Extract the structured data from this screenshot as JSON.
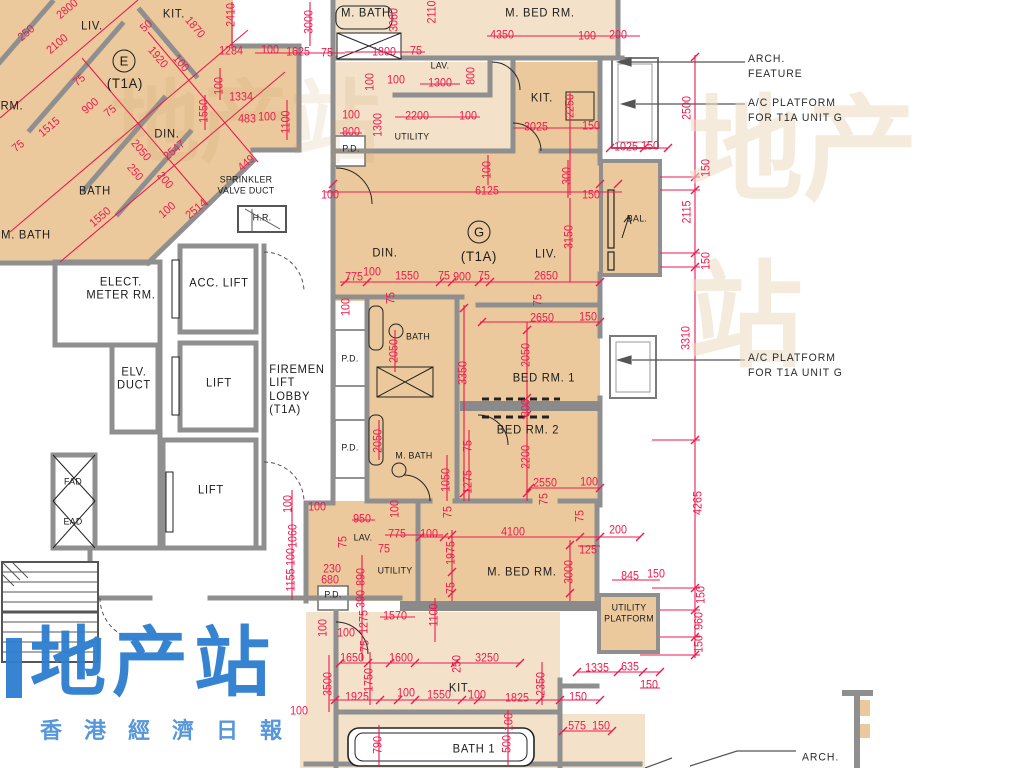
{
  "document": {
    "kind": "architectural floor plan",
    "tower_type": "T1A"
  },
  "palette": {
    "unit_fill": "#ebc99c",
    "unit_fill_light": "#f3e2c9",
    "wall_gray": "#8f8f8f",
    "dim_red": "#ed1a4e",
    "text_black": "#1b1b1b",
    "watermark_blue": "#2e7fd0"
  },
  "watermark": {
    "title": "地产站",
    "subtitle": "香港經濟日報"
  },
  "units": [
    {
      "id": "E",
      "badge": "E",
      "type": "(T1A)"
    },
    {
      "id": "G",
      "badge": "G",
      "type": "(T1A)"
    }
  ],
  "annotations": [
    {
      "t": "ARCH.\nFEATURE",
      "x": 748,
      "y": 67
    },
    {
      "t": "A/C PLATFORM\nFOR T1A UNIT G",
      "x": 748,
      "y": 111
    },
    {
      "t": "A/C PLATFORM\nFOR T1A UNIT G",
      "x": 748,
      "y": 366
    },
    {
      "t": "ARCH.",
      "x": 802,
      "y": 758
    }
  ],
  "rooms": [
    {
      "t": "LIV.",
      "x": 92,
      "y": 26
    },
    {
      "t": "KIT.",
      "x": 174,
      "y": 14
    },
    {
      "t": "E",
      "x": 124,
      "y": 61,
      "k": "badge"
    },
    {
      "t": "(T1A)",
      "x": 125,
      "y": 84,
      "k": "big"
    },
    {
      "t": "DIN.",
      "x": 167,
      "y": 134
    },
    {
      "t": "RM.",
      "x": 12,
      "y": 106
    },
    {
      "t": "BATH",
      "x": 95,
      "y": 191
    },
    {
      "t": "M. BATH",
      "x": 26,
      "y": 235
    },
    {
      "t": "SPRINKLER\nVALVE DUCT",
      "x": 246,
      "y": 186,
      "k": "small"
    },
    {
      "t": "H.R.",
      "x": 262,
      "y": 219,
      "k": "small"
    },
    {
      "t": "M. BATH",
      "x": 366,
      "y": 13
    },
    {
      "t": "M. BED RM.",
      "x": 540,
      "y": 13
    },
    {
      "t": "LAV.",
      "x": 440,
      "y": 67,
      "k": "small"
    },
    {
      "t": "UTILITY",
      "x": 412,
      "y": 138,
      "k": "small"
    },
    {
      "t": "P.D.",
      "x": 351,
      "y": 150,
      "k": "small"
    },
    {
      "t": "KIT.",
      "x": 542,
      "y": 98
    },
    {
      "t": "G",
      "x": 479,
      "y": 232,
      "k": "badge"
    },
    {
      "t": "(T1A)",
      "x": 479,
      "y": 257,
      "k": "big"
    },
    {
      "t": "DIN.",
      "x": 385,
      "y": 253
    },
    {
      "t": "LIV.",
      "x": 546,
      "y": 254
    },
    {
      "t": "BAL.",
      "x": 637,
      "y": 220,
      "k": "small"
    },
    {
      "t": "ELECT.\nMETER RM.",
      "x": 121,
      "y": 289
    },
    {
      "t": "ACC. LIFT",
      "x": 219,
      "y": 283
    },
    {
      "t": "ELV.\nDUCT",
      "x": 134,
      "y": 379
    },
    {
      "t": "LIFT",
      "x": 219,
      "y": 383
    },
    {
      "t": "FIREMEN\nLIFT\nLOBBY\n(T1A)",
      "x": 297,
      "y": 390,
      "k": "left"
    },
    {
      "t": "LIFT",
      "x": 211,
      "y": 490
    },
    {
      "t": "FAD",
      "x": 73,
      "y": 483,
      "k": "small"
    },
    {
      "t": "EAD",
      "x": 73,
      "y": 523,
      "k": "small"
    },
    {
      "t": "P.D.",
      "x": 350,
      "y": 360,
      "k": "small"
    },
    {
      "t": "BATH",
      "x": 418,
      "y": 338,
      "k": "small"
    },
    {
      "t": "BED RM. 1",
      "x": 544,
      "y": 378
    },
    {
      "t": "P.D.",
      "x": 350,
      "y": 449,
      "k": "small"
    },
    {
      "t": "BED RM. 2",
      "x": 528,
      "y": 430
    },
    {
      "t": "M. BATH",
      "x": 414,
      "y": 457,
      "k": "small"
    },
    {
      "t": "LAV.",
      "x": 363,
      "y": 539,
      "k": "small"
    },
    {
      "t": "UTILITY",
      "x": 395,
      "y": 572,
      "k": "small"
    },
    {
      "t": "P.D.",
      "x": 333,
      "y": 596,
      "k": "small"
    },
    {
      "t": "M. BED RM.",
      "x": 522,
      "y": 572
    },
    {
      "t": "UTILITY\nPLATFORM",
      "x": 629,
      "y": 614,
      "k": "small"
    },
    {
      "t": "KIT.",
      "x": 460,
      "y": 688
    },
    {
      "t": "BATH 1",
      "x": 474,
      "y": 749
    }
  ],
  "dims": [
    {
      "t": "2800",
      "x": 68,
      "y": 10,
      "r": -40
    },
    {
      "t": "50",
      "x": 147,
      "y": 27,
      "r": -40
    },
    {
      "t": "250",
      "x": 27,
      "y": 34,
      "r": -40
    },
    {
      "t": "2100",
      "x": 58,
      "y": 45,
      "r": -40
    },
    {
      "t": "1870",
      "x": 194,
      "y": 28,
      "r": 50
    },
    {
      "t": "1920",
      "x": 157,
      "y": 58,
      "r": 50
    },
    {
      "t": "100",
      "x": 180,
      "y": 64,
      "r": 50
    },
    {
      "t": "2410",
      "x": 232,
      "y": 15,
      "r": -90
    },
    {
      "t": "1284",
      "x": 231,
      "y": 52,
      "r": 0
    },
    {
      "t": "100",
      "x": 270,
      "y": 51,
      "r": 0
    },
    {
      "t": "1625",
      "x": 298,
      "y": 53,
      "r": 0
    },
    {
      "t": "75",
      "x": 327,
      "y": 54,
      "r": 0
    },
    {
      "t": "3000",
      "x": 310,
      "y": 22,
      "r": -90
    },
    {
      "t": "100",
      "x": 220,
      "y": 86,
      "r": -90
    },
    {
      "t": "1334",
      "x": 241,
      "y": 98,
      "r": 0
    },
    {
      "t": "1550",
      "x": 205,
      "y": 111,
      "r": -90
    },
    {
      "t": "483",
      "x": 247,
      "y": 120,
      "r": 0
    },
    {
      "t": "100",
      "x": 267,
      "y": 118,
      "r": 0
    },
    {
      "t": "1100",
      "x": 287,
      "y": 122,
      "r": -90
    },
    {
      "t": "75",
      "x": 80,
      "y": 81,
      "r": -40
    },
    {
      "t": "900",
      "x": 91,
      "y": 107,
      "r": -40
    },
    {
      "t": "75",
      "x": 111,
      "y": 112,
      "r": -40
    },
    {
      "t": "1515",
      "x": 50,
      "y": 128,
      "r": -40
    },
    {
      "t": "75",
      "x": 19,
      "y": 147,
      "r": -40
    },
    {
      "t": "2050",
      "x": 140,
      "y": 151,
      "r": 50
    },
    {
      "t": "2547",
      "x": 175,
      "y": 151,
      "r": -40
    },
    {
      "t": "250",
      "x": 134,
      "y": 173,
      "r": 50
    },
    {
      "t": "200",
      "x": 164,
      "y": 181,
      "r": 50
    },
    {
      "t": "449",
      "x": 247,
      "y": 164,
      "r": -40
    },
    {
      "t": "1550",
      "x": 101,
      "y": 218,
      "r": -40
    },
    {
      "t": "2514",
      "x": 197,
      "y": 210,
      "r": -40
    },
    {
      "t": "100",
      "x": 168,
      "y": 211,
      "r": -40
    },
    {
      "t": "3060",
      "x": 395,
      "y": 20,
      "r": -90
    },
    {
      "t": "2110",
      "x": 433,
      "y": 12,
      "r": -90
    },
    {
      "t": "4350",
      "x": 502,
      "y": 36,
      "r": 0
    },
    {
      "t": "100",
      "x": 587,
      "y": 37,
      "r": 0
    },
    {
      "t": "200",
      "x": 618,
      "y": 36,
      "r": 0
    },
    {
      "t": "1800",
      "x": 384,
      "y": 53,
      "r": 0
    },
    {
      "t": "75",
      "x": 416,
      "y": 52,
      "r": 0
    },
    {
      "t": "100",
      "x": 371,
      "y": 82,
      "r": -90
    },
    {
      "t": "100",
      "x": 396,
      "y": 81,
      "r": 0
    },
    {
      "t": "1300",
      "x": 440,
      "y": 84,
      "r": 0
    },
    {
      "t": "800",
      "x": 472,
      "y": 76,
      "r": -90
    },
    {
      "t": "2200",
      "x": 417,
      "y": 117,
      "r": 0
    },
    {
      "t": "100",
      "x": 468,
      "y": 117,
      "r": 0
    },
    {
      "t": "1300",
      "x": 379,
      "y": 125,
      "r": -90
    },
    {
      "t": "100",
      "x": 351,
      "y": 116,
      "r": 0
    },
    {
      "t": "800",
      "x": 351,
      "y": 133,
      "r": 0
    },
    {
      "t": "2250",
      "x": 571,
      "y": 106,
      "r": -90
    },
    {
      "t": "3025",
      "x": 536,
      "y": 128,
      "r": 0
    },
    {
      "t": "150",
      "x": 591,
      "y": 127,
      "r": 0
    },
    {
      "t": "1025",
      "x": 626,
      "y": 148,
      "r": 0
    },
    {
      "t": "150",
      "x": 650,
      "y": 147,
      "r": 0
    },
    {
      "t": "2500",
      "x": 688,
      "y": 108,
      "r": -90
    },
    {
      "t": "100",
      "x": 330,
      "y": 196,
      "r": 0
    },
    {
      "t": "6125",
      "x": 487,
      "y": 192,
      "r": 0
    },
    {
      "t": "150",
      "x": 591,
      "y": 196,
      "r": 0
    },
    {
      "t": "300",
      "x": 568,
      "y": 176,
      "r": -90
    },
    {
      "t": "100",
      "x": 488,
      "y": 170,
      "r": -90
    },
    {
      "t": "3150",
      "x": 570,
      "y": 237,
      "r": -90
    },
    {
      "t": "775",
      "x": 354,
      "y": 278,
      "r": 0
    },
    {
      "t": "100",
      "x": 372,
      "y": 273,
      "r": 0
    },
    {
      "t": "1550",
      "x": 407,
      "y": 277,
      "r": 0
    },
    {
      "t": "75",
      "x": 444,
      "y": 277,
      "r": 0
    },
    {
      "t": "900",
      "x": 462,
      "y": 278,
      "r": 0
    },
    {
      "t": "75",
      "x": 484,
      "y": 277,
      "r": 0
    },
    {
      "t": "2650",
      "x": 546,
      "y": 277,
      "r": 0
    },
    {
      "t": "75",
      "x": 392,
      "y": 298,
      "r": -90
    },
    {
      "t": "75",
      "x": 539,
      "y": 300,
      "r": -90
    },
    {
      "t": "100",
      "x": 347,
      "y": 307,
      "r": -90
    },
    {
      "t": "150",
      "x": 707,
      "y": 168,
      "r": -90
    },
    {
      "t": "2115",
      "x": 688,
      "y": 212,
      "r": -90
    },
    {
      "t": "150",
      "x": 707,
      "y": 261,
      "r": -90
    },
    {
      "t": "3310",
      "x": 687,
      "y": 338,
      "r": -90
    },
    {
      "t": "2650",
      "x": 542,
      "y": 319,
      "r": 0
    },
    {
      "t": "150",
      "x": 588,
      "y": 318,
      "r": 0
    },
    {
      "t": "2050",
      "x": 527,
      "y": 355,
      "r": -90
    },
    {
      "t": "300",
      "x": 527,
      "y": 408,
      "r": -90
    },
    {
      "t": "2200",
      "x": 527,
      "y": 457,
      "r": -90
    },
    {
      "t": "2550",
      "x": 545,
      "y": 484,
      "r": 0
    },
    {
      "t": "100",
      "x": 589,
      "y": 483,
      "r": 0
    },
    {
      "t": "75",
      "x": 545,
      "y": 499,
      "r": -90
    },
    {
      "t": "2050",
      "x": 395,
      "y": 351,
      "r": -90
    },
    {
      "t": "3350",
      "x": 464,
      "y": 373,
      "r": -90
    },
    {
      "t": "2050",
      "x": 379,
      "y": 441,
      "r": -90
    },
    {
      "t": "1050",
      "x": 447,
      "y": 480,
      "r": -90
    },
    {
      "t": "75",
      "x": 469,
      "y": 446,
      "r": -90
    },
    {
      "t": "1275",
      "x": 469,
      "y": 482,
      "r": -90
    },
    {
      "t": "75",
      "x": 449,
      "y": 512,
      "r": -90
    },
    {
      "t": "100",
      "x": 396,
      "y": 509,
      "r": -90
    },
    {
      "t": "100",
      "x": 289,
      "y": 504,
      "r": -90
    },
    {
      "t": "1060",
      "x": 294,
      "y": 536,
      "r": -90
    },
    {
      "t": "100",
      "x": 292,
      "y": 557,
      "r": -90
    },
    {
      "t": "1155",
      "x": 292,
      "y": 580,
      "r": -90
    },
    {
      "t": "100",
      "x": 317,
      "y": 508,
      "r": 0
    },
    {
      "t": "75",
      "x": 344,
      "y": 542,
      "r": -90
    },
    {
      "t": "950",
      "x": 362,
      "y": 520,
      "r": 0
    },
    {
      "t": "775",
      "x": 397,
      "y": 535,
      "r": 0
    },
    {
      "t": "100",
      "x": 429,
      "y": 535,
      "r": 0
    },
    {
      "t": "75",
      "x": 384,
      "y": 550,
      "r": 0
    },
    {
      "t": "230",
      "x": 332,
      "y": 570,
      "r": 0
    },
    {
      "t": "680",
      "x": 330,
      "y": 581,
      "r": 0
    },
    {
      "t": "890",
      "x": 362,
      "y": 577,
      "r": -90
    },
    {
      "t": "390",
      "x": 362,
      "y": 599,
      "r": -90
    },
    {
      "t": "1275",
      "x": 365,
      "y": 622,
      "r": -90
    },
    {
      "t": "75",
      "x": 366,
      "y": 646,
      "r": -90
    },
    {
      "t": "1570",
      "x": 395,
      "y": 617,
      "r": 0
    },
    {
      "t": "1100",
      "x": 435,
      "y": 615,
      "r": -90
    },
    {
      "t": "100",
      "x": 324,
      "y": 628,
      "r": -90
    },
    {
      "t": "100",
      "x": 346,
      "y": 634,
      "r": 0
    },
    {
      "t": "100",
      "x": 299,
      "y": 712,
      "r": 0
    },
    {
      "t": "1975",
      "x": 452,
      "y": 553,
      "r": -90
    },
    {
      "t": "75",
      "x": 452,
      "y": 588,
      "r": -90
    },
    {
      "t": "4100",
      "x": 513,
      "y": 533,
      "r": 0
    },
    {
      "t": "75",
      "x": 581,
      "y": 516,
      "r": -90
    },
    {
      "t": "125",
      "x": 588,
      "y": 551,
      "r": 0
    },
    {
      "t": "200",
      "x": 618,
      "y": 531,
      "r": 0
    },
    {
      "t": "3000",
      "x": 570,
      "y": 572,
      "r": -90
    },
    {
      "t": "845",
      "x": 630,
      "y": 577,
      "r": 0
    },
    {
      "t": "150",
      "x": 656,
      "y": 575,
      "r": 0
    },
    {
      "t": "150",
      "x": 702,
      "y": 595,
      "r": -90
    },
    {
      "t": "960",
      "x": 700,
      "y": 621,
      "r": -90
    },
    {
      "t": "150",
      "x": 700,
      "y": 644,
      "r": -90
    },
    {
      "t": "4265",
      "x": 699,
      "y": 503,
      "r": -90
    },
    {
      "t": "1335",
      "x": 597,
      "y": 669,
      "r": 0
    },
    {
      "t": "635",
      "x": 630,
      "y": 668,
      "r": 0
    },
    {
      "t": "150",
      "x": 649,
      "y": 686,
      "r": 0
    },
    {
      "t": "150",
      "x": 578,
      "y": 698,
      "r": 0
    },
    {
      "t": "575",
      "x": 577,
      "y": 727,
      "r": 0
    },
    {
      "t": "150",
      "x": 601,
      "y": 727,
      "r": 0
    },
    {
      "t": "1650",
      "x": 352,
      "y": 659,
      "r": 0
    },
    {
      "t": "1600",
      "x": 401,
      "y": 659,
      "r": 0
    },
    {
      "t": "250",
      "x": 458,
      "y": 664,
      "r": -90
    },
    {
      "t": "3250",
      "x": 487,
      "y": 659,
      "r": 0
    },
    {
      "t": "3500",
      "x": 329,
      "y": 684,
      "r": -90
    },
    {
      "t": "1750",
      "x": 370,
      "y": 680,
      "r": -90
    },
    {
      "t": "1925",
      "x": 357,
      "y": 698,
      "r": 0
    },
    {
      "t": "100",
      "x": 406,
      "y": 694,
      "r": 0
    },
    {
      "t": "1550",
      "x": 439,
      "y": 696,
      "r": 0
    },
    {
      "t": "100",
      "x": 477,
      "y": 696,
      "r": 0
    },
    {
      "t": "1825",
      "x": 517,
      "y": 699,
      "r": 0
    },
    {
      "t": "2350",
      "x": 542,
      "y": 684,
      "r": -90
    },
    {
      "t": "790",
      "x": 379,
      "y": 745,
      "r": -90
    },
    {
      "t": "500",
      "x": 508,
      "y": 744,
      "r": -90
    },
    {
      "t": "100",
      "x": 510,
      "y": 722,
      "r": -90
    }
  ]
}
